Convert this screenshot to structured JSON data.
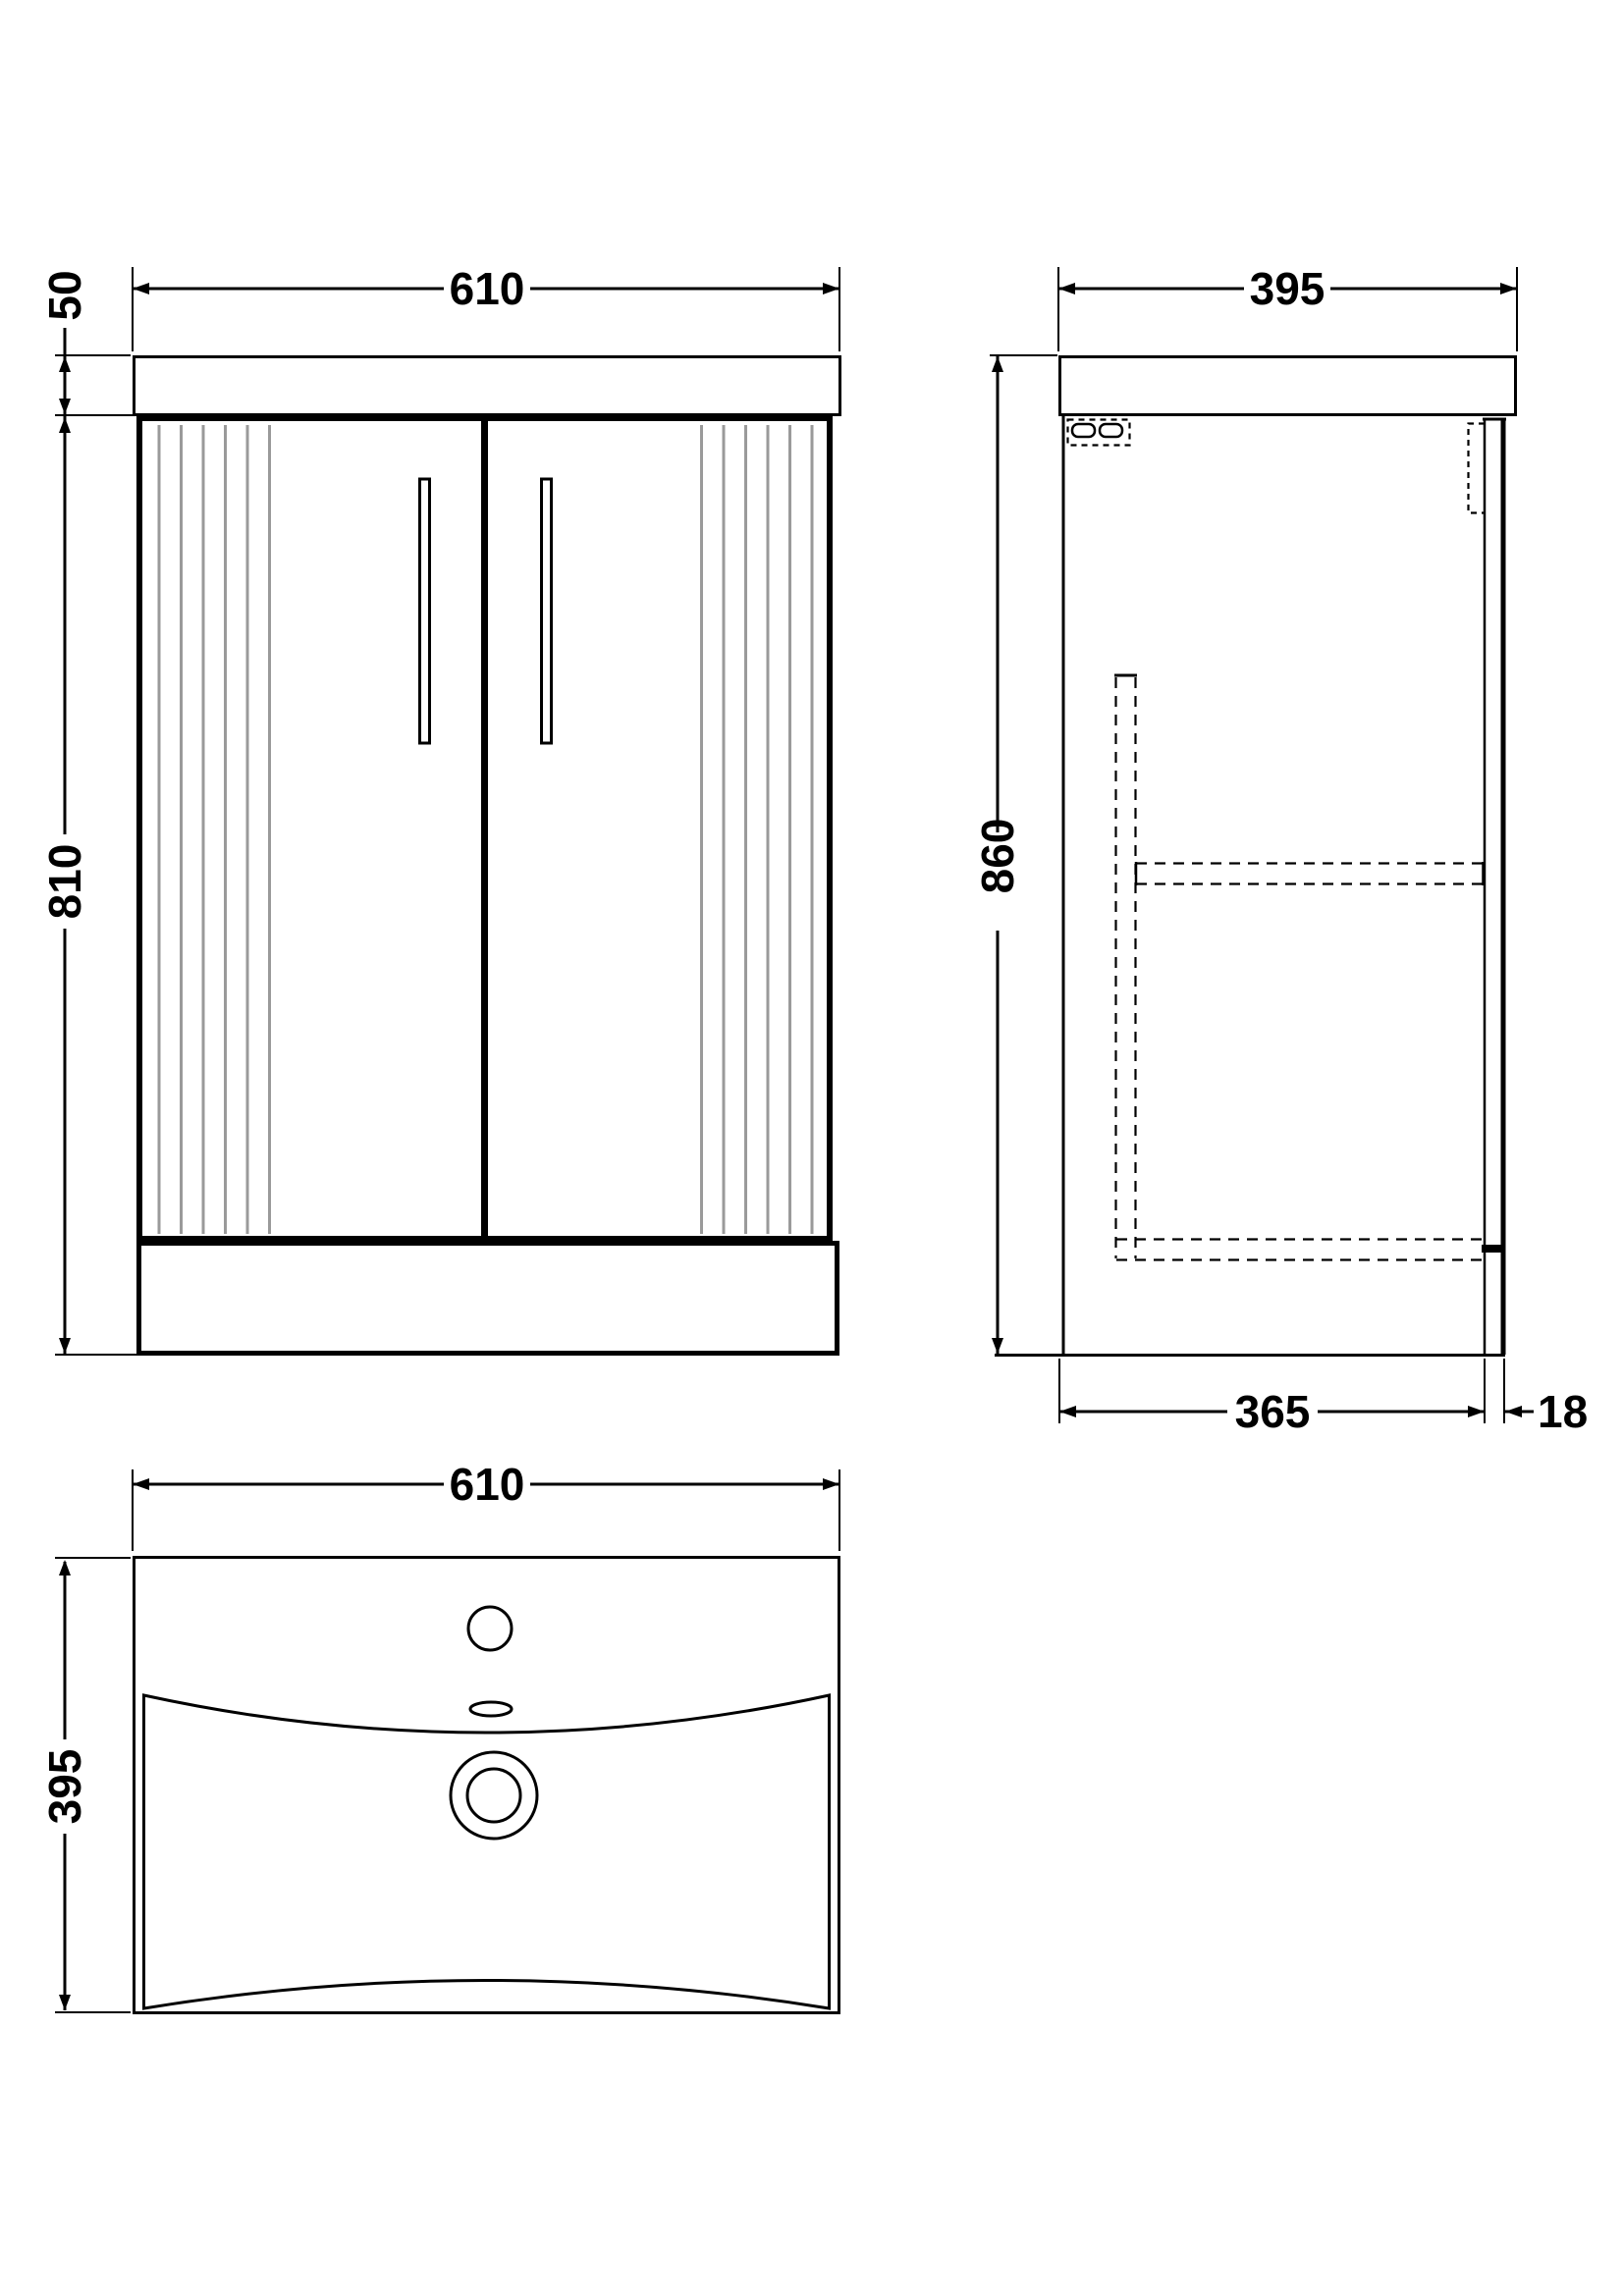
{
  "drawing": {
    "background": "#ffffff",
    "line_color": "#000000",
    "flute_color": "#9a9a9a",
    "views": {
      "front": {
        "label": "front-view",
        "width_mm": "610",
        "worktop_height_mm": "50",
        "cabinet_height_mm": "810"
      },
      "side": {
        "label": "side-view",
        "depth_mm": "395",
        "overall_height_mm": "860",
        "carcass_depth_mm": "365",
        "back_panel_mm": "18"
      },
      "plan": {
        "label": "basin-plan-view",
        "width_mm": "610",
        "depth_mm": "395"
      }
    }
  }
}
